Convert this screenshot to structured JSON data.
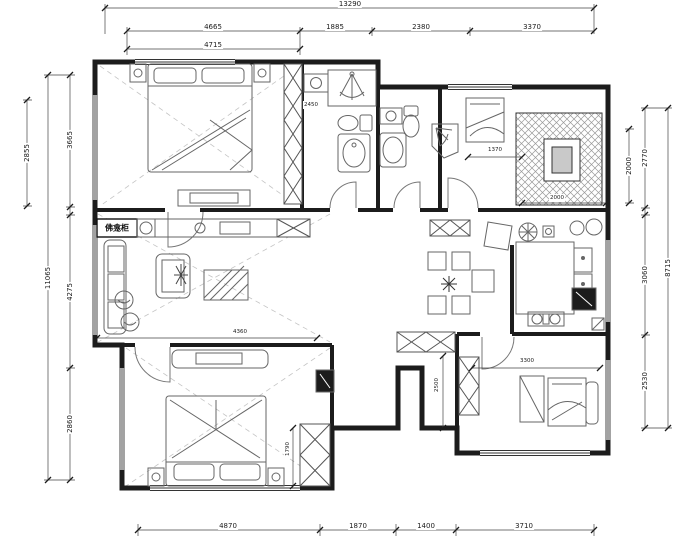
{
  "drawing": {
    "type": "apartment floor plan",
    "cabinet_label": "佛龛柜"
  },
  "dims": {
    "top_overall": "13290",
    "top_segments": [
      "4665",
      "1885",
      "2380",
      "3370"
    ],
    "top_sub": "4715",
    "left_room": "2855",
    "left_overall": "11065",
    "left_segments": [
      "3665",
      "4275",
      "2860"
    ],
    "right_inner": "2000",
    "right_segments": [
      "2770",
      "3060",
      "2530"
    ],
    "right_overall": "8715",
    "bottom_segments": [
      "4870",
      "1870",
      "1400",
      "3710"
    ],
    "interior": {
      "closet": "2450",
      "niche": "1370",
      "storage": "2000",
      "living": "4360",
      "hall": "2500",
      "bedroom3": "3300",
      "wardrobe": "1790"
    }
  }
}
